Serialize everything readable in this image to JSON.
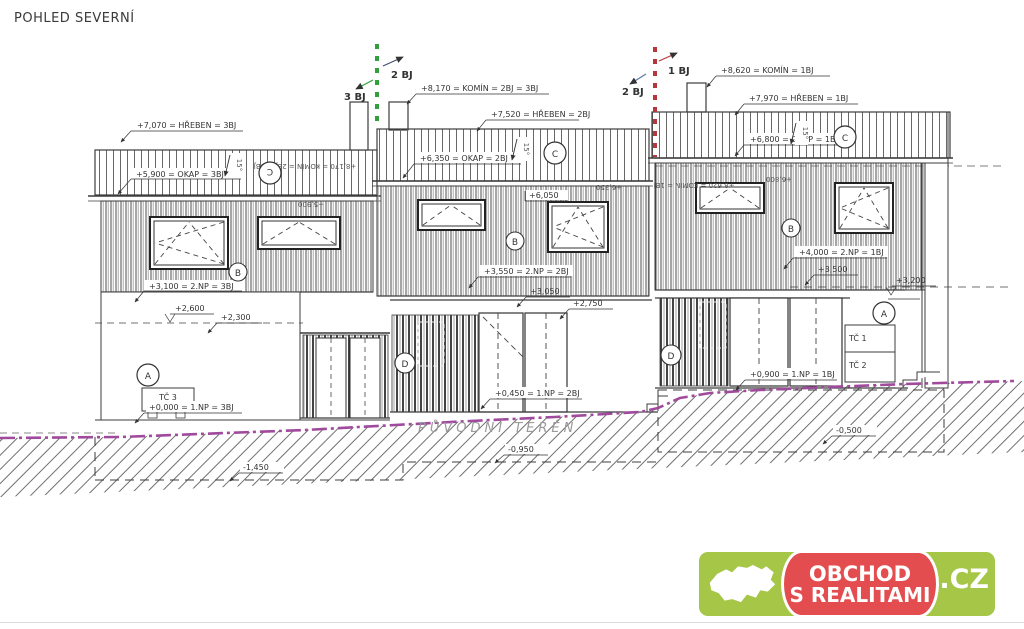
{
  "title": "POHLED SEVERNÍ",
  "unit_markers": {
    "left_boundary": {
      "left": "3 BJ",
      "right": "2 BJ"
    },
    "right_boundary": {
      "left": "2 BJ",
      "right": "1 BJ"
    }
  },
  "levels": {
    "komin_23": "+8,170 = KOMÍN = 2BJ = 3BJ",
    "hreben_2": "+7,520 = HŘEBEN = 2BJ",
    "okap_2": "+6,350 = OKAP = 2BJ",
    "hreben_3": "+7,070 = HŘEBEN = 3BJ",
    "okap_3": "+5,900 = OKAP = 3BJ",
    "komin_1": "+8,620 = KOMÍN = 1BJ",
    "hreben_1": "+7,970 = HŘEBEN = 1BJ",
    "okap_1": "+6,800 = OKAP = 1BJ",
    "np2_3": "+3,100 = 2.NP = 3BJ",
    "np2_2": "+3,550 = 2.NP = 2BJ",
    "np2_1": "+4,000 = 2.NP = 1BJ",
    "np1_3": "+0,000 = 1.NP = 3BJ",
    "np1_2": "+0,450 = 1.NP = 2BJ",
    "np1_1": "+0,900 = 1.NP = 1BJ",
    "l2600": "+2,600",
    "l2300": "+2,300",
    "l6050": "+6,050",
    "l3050": "+3,050",
    "l2750": "+2,750",
    "l3500": "+3,500",
    "l3200": "+3,200",
    "s5900": "+5,900",
    "s6350": "+6,350",
    "s6800": "+6,800",
    "m1450": "-1,450",
    "m0950": "-0,950",
    "m0500": "-0,500"
  },
  "roof_slope": "15°",
  "ref_markers": {
    "a": "A",
    "b": "B",
    "c": "C",
    "d": "D"
  },
  "equipment": {
    "tc1": "TČ 1",
    "tc2": "TČ 2",
    "tc3": "TČ 3"
  },
  "terrain": {
    "label": "PŮVODNÍ TERÉN",
    "color": "#a04a9e"
  },
  "colors": {
    "line": "#3a3a3a",
    "unit3_green": "#2fa03c",
    "unit1_red": "#b5373b",
    "unit2_blue": "#5c7ea8",
    "unit2_dark": "#44506b",
    "logo_green": "#a6c648",
    "logo_red": "#e44d4f"
  },
  "logo": {
    "line1": "OBCHOD",
    "line2": "S REALITAMI",
    "tld": ".CZ"
  }
}
